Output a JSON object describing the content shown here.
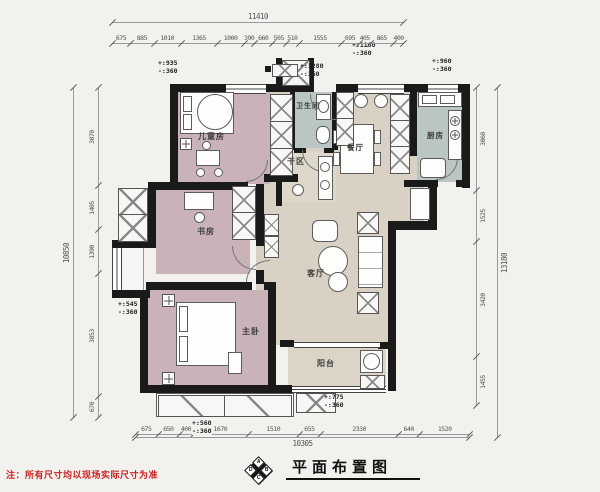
{
  "title": "平面布置图",
  "note": "注：所有尺寸均以现场实际尺寸为准",
  "compass": {
    "top": "A",
    "right": "B",
    "bottom": "C",
    "left": "D"
  },
  "rooms": {
    "children": "儿童房",
    "bathroom": "卫生间",
    "dry": "干区",
    "dining": "餐厅",
    "kitchen": "厨房",
    "study": "书房",
    "master": "主卧",
    "living": "客厅",
    "balcony": "阳台"
  },
  "elevations": {
    "children": {
      "plus": "+:935",
      "minus": "-:360"
    },
    "entry": {
      "plus": "+:1280",
      "minus": "-:360"
    },
    "dining_top": {
      "plus": "+:1160",
      "minus": "-:360"
    },
    "kitchen": {
      "plus": "+:960",
      "minus": "-:360"
    },
    "left_bay": {
      "plus": "+:545",
      "minus": "-:360"
    },
    "master_bottom": {
      "plus": "+:560",
      "minus": "-:360"
    },
    "balcony": {
      "plus": "+:775",
      "minus": "-:360"
    }
  },
  "dims": {
    "top": {
      "total": "11410",
      "segments": [
        675,
        885,
        1010,
        1365,
        1000,
        390,
        660,
        505,
        510,
        1555,
        695,
        405,
        865,
        400
      ]
    },
    "bottom": {
      "total": "10305",
      "segments": [
        675,
        650,
        400,
        1670,
        1510,
        655,
        2330,
        640,
        1520
      ]
    },
    "left": {
      "total": "10850",
      "segments": [
        3070,
        1405,
        1390,
        3853,
        670
      ]
    },
    "right": {
      "total": "13180",
      "segments": [
        3060,
        1525,
        3420,
        1455
      ]
    }
  },
  "colors": {
    "wall": "#1a1a1a",
    "bedroom": "#c9b2b8",
    "wet": "#b9c6c3",
    "living": "#d9d1c3",
    "balcony": "#dcd5c7",
    "dry": "#ded8cb",
    "background": "#f2f1ed",
    "note": "#cc2222"
  }
}
